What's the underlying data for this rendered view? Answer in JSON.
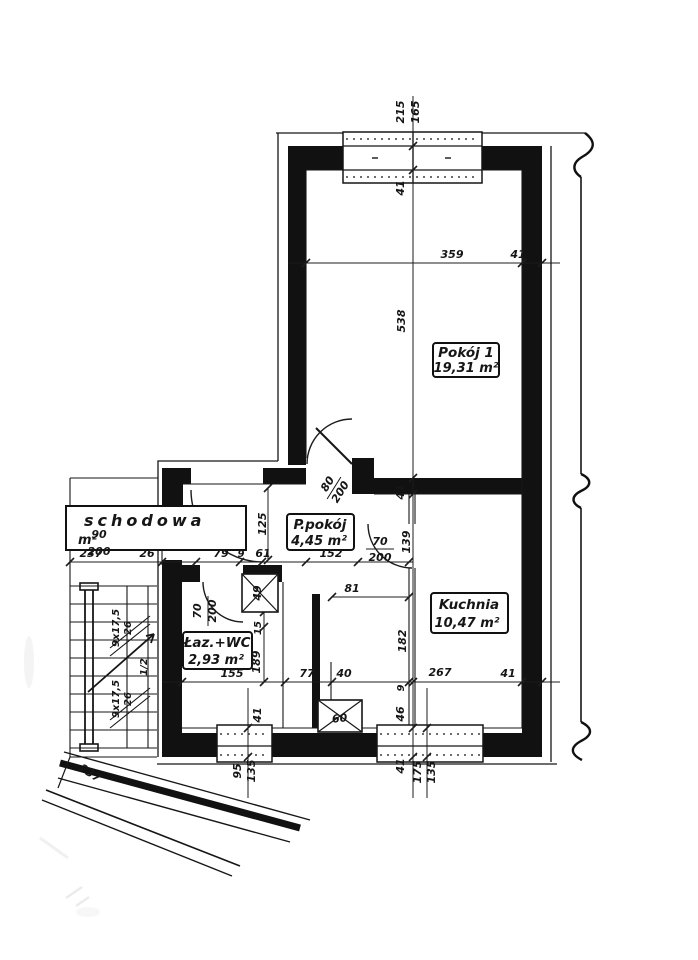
{
  "meta": {
    "paper": "#ffffff",
    "ink": "#161616"
  },
  "rooms": {
    "pokoj1": {
      "name": "Pokój 1",
      "area": "19,31  m²"
    },
    "ppokoj": {
      "name": "P.pokój",
      "area": "4,45   m²"
    },
    "kuchnia": {
      "name": "Kuchnia",
      "area": "10,47  m²"
    },
    "lazwc": {
      "name": "Łaz.+WC",
      "area": "2,93  m²"
    },
    "schodowa": {
      "name": "schodowa",
      "area": "m²"
    }
  },
  "openings": {
    "window_top": {
      "w": "215",
      "h": "165"
    },
    "window_kuchnia": {
      "w": "175",
      "h": "135"
    },
    "window_laz": {
      "w": "95",
      "h": "135"
    },
    "door_entry": {
      "w": "90",
      "h": "200"
    },
    "door_pokoj1": {
      "w": "80",
      "h": "200"
    },
    "door_kuchnia": {
      "w": "70",
      "h": "200"
    },
    "door_laz": {
      "w": "70",
      "h": "200"
    }
  },
  "shafts": {
    "hall": "60",
    "laz": "49"
  },
  "stairs": {
    "flight1_steps": "9x17,5",
    "flight1_tread": "26",
    "flight2_steps": "9x17,5",
    "flight2_tread": "26",
    "level_mark": "1/2"
  },
  "dims": {
    "room1_width": "359",
    "room1_wall": "41",
    "room1_length": "538",
    "top_wall": "41",
    "mid_wall": "41",
    "hall_height": "139",
    "kuchnia_height": "182",
    "kuchnia_width": "267",
    "kuchnia_wall": "41",
    "laz_width": "155",
    "hall_bottom": "77",
    "shaft_gap": "40",
    "bottom_9": "9",
    "bottom_46": "46",
    "bottom_wall": "41",
    "stair_width": "237",
    "stair_gap": "26",
    "entry_79": "79",
    "entry_9": "9",
    "entry_61": "61",
    "hall_length": "152",
    "hall_width": "125",
    "laz_wall": "15",
    "laz_height": "189",
    "duct_81": "81",
    "laz_window_wall": "41",
    "diag_wall": "237"
  }
}
